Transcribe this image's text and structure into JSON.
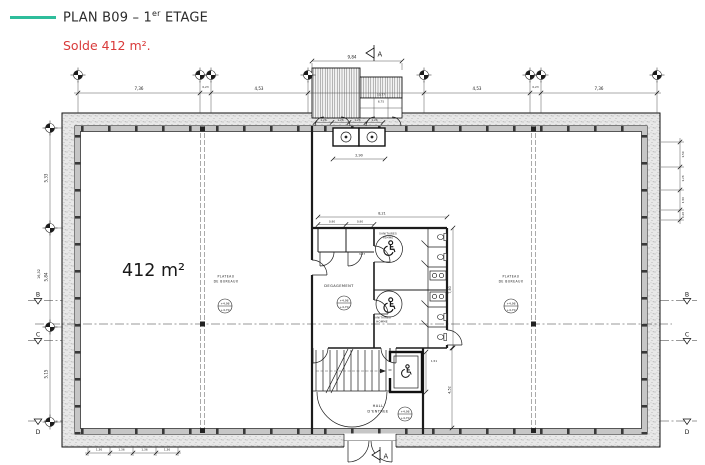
{
  "colors": {
    "accent_teal": "#2ebd9b",
    "accent_red": "#d93a3a",
    "wall_fill": "#e8e8e8"
  },
  "header": {
    "title_pre": "PLAN B09 – 1",
    "title_sup": "er",
    "title_post": " ETAGE",
    "subtitle": "Solde 412 m²."
  },
  "plan": {
    "area_label": "412 m²",
    "rooms": {
      "plateau_line1": "PLATEAU",
      "plateau_line2": "DE BUREAUX",
      "degagement": "DEGAGEMENT",
      "sanitaires": "SANITAIRES",
      "femme": "FEMME",
      "homme": "HOMME",
      "hall_line1": "HALL",
      "hall_line2": "D'ENTREE"
    },
    "levels": {
      "line1": "+4,98",
      "line2": "+4,70"
    },
    "grid": {
      "a": "A",
      "b": "B",
      "c": "C",
      "d": "D"
    },
    "dims": {
      "top": [
        "7,36",
        "0,23",
        "4,53",
        "4,53",
        "0,23",
        "7,36"
      ],
      "left": [
        "5,33",
        "5,84",
        "5,15"
      ],
      "left_total": "16,32",
      "right": [
        "1,50",
        "1,26",
        "1,50",
        "0,26"
      ],
      "bottom": [
        "1,36",
        "1,36",
        "1,36",
        "1,36"
      ],
      "canopy_width": "9,84",
      "canopy_a": "10,77",
      "canopy_b": "6,75",
      "canopy_doors": [
        "1,26",
        "1,26",
        "1,26",
        "1,26"
      ],
      "shaft": "2,90",
      "core_width": "8,21",
      "core_a": "0,90",
      "core_b": "0,90",
      "core_c": "3,67",
      "elevator": "1,51",
      "core_right": "7,80",
      "hall_right": "4,52"
    }
  }
}
